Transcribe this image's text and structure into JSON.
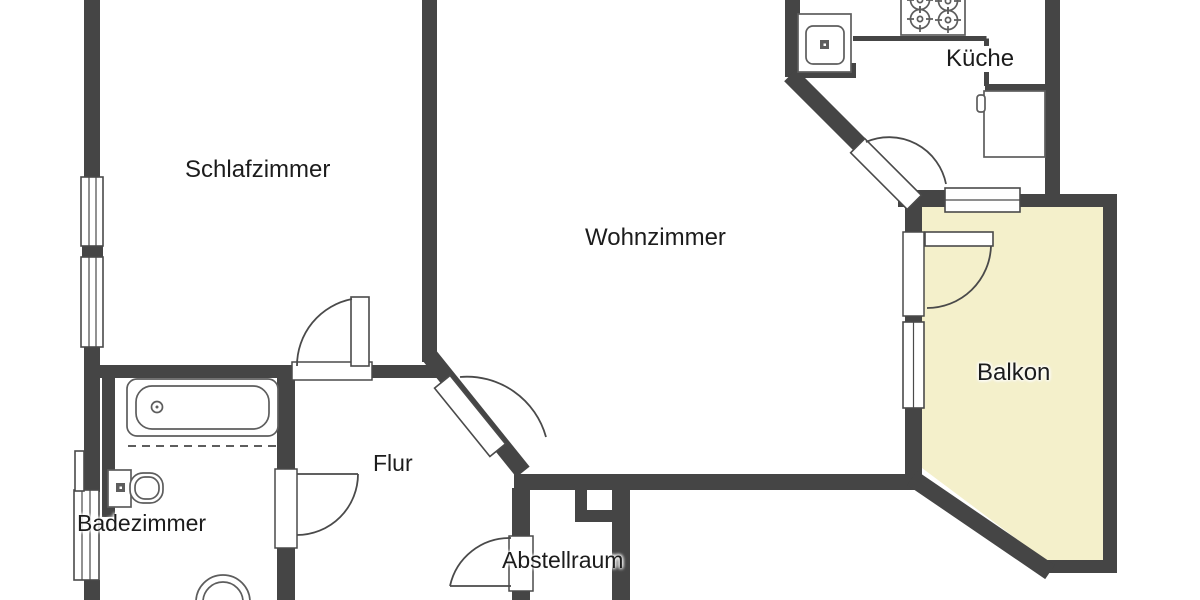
{
  "plan": {
    "type": "apartment-floor-plan",
    "colors": {
      "wall": "#454545",
      "balcony_fill": "#f4f0cb",
      "background": "#ffffff",
      "fixture_line": "#5d5d5d",
      "text": "#1c1c1c"
    },
    "rooms": {
      "schlafzimmer": {
        "label": "Schlafzimmer"
      },
      "wohnzimmer": {
        "label": "Wohnzimmer"
      },
      "kueche": {
        "label": "Küche"
      },
      "balkon": {
        "label": "Balkon"
      },
      "flur": {
        "label": "Flur"
      },
      "badezimmer": {
        "label": "Badezimmer"
      },
      "abstellraum": {
        "label": "Abstellraum"
      }
    },
    "fixtures": [
      {
        "name": "bathtub-icon"
      },
      {
        "name": "toilet-icon"
      },
      {
        "name": "washbasin-icon"
      },
      {
        "name": "kitchen-sink-icon"
      },
      {
        "name": "stove-icon"
      },
      {
        "name": "refrigerator-icon"
      }
    ],
    "features": [
      "windows-left-wall",
      "windows-balcony",
      "balcony-door",
      "room-doors-with-swing-arcs",
      "duct-shaft-near-abstellraum"
    ]
  }
}
